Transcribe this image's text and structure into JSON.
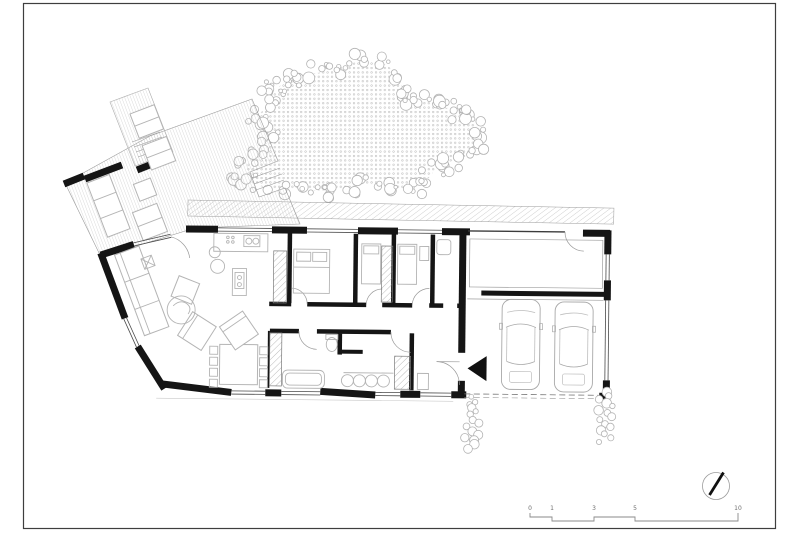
{
  "sheet": {
    "background": "#ffffff"
  },
  "colors": {
    "wall": "#151515",
    "line": "#9e9e9e",
    "furniture": "#b4b4b4",
    "veg": "#b3b3b3",
    "frame": "#3e3e3e",
    "label": "#6f6f6f",
    "hatch": "#ababab"
  },
  "scale_bar": {
    "labels": [
      "0",
      "1",
      "3",
      "5",
      "10"
    ]
  },
  "north_indicator": {
    "icon": "north-needle-icon"
  },
  "plan": {
    "car_count": 2,
    "vegetation": {
      "tree_cloud_center": [
        356,
        133
      ],
      "tree_cloud_radii": [
        108,
        62
      ],
      "shrub_clusters": [
        [
          472,
          396
        ],
        [
          606,
          390
        ]
      ]
    }
  }
}
